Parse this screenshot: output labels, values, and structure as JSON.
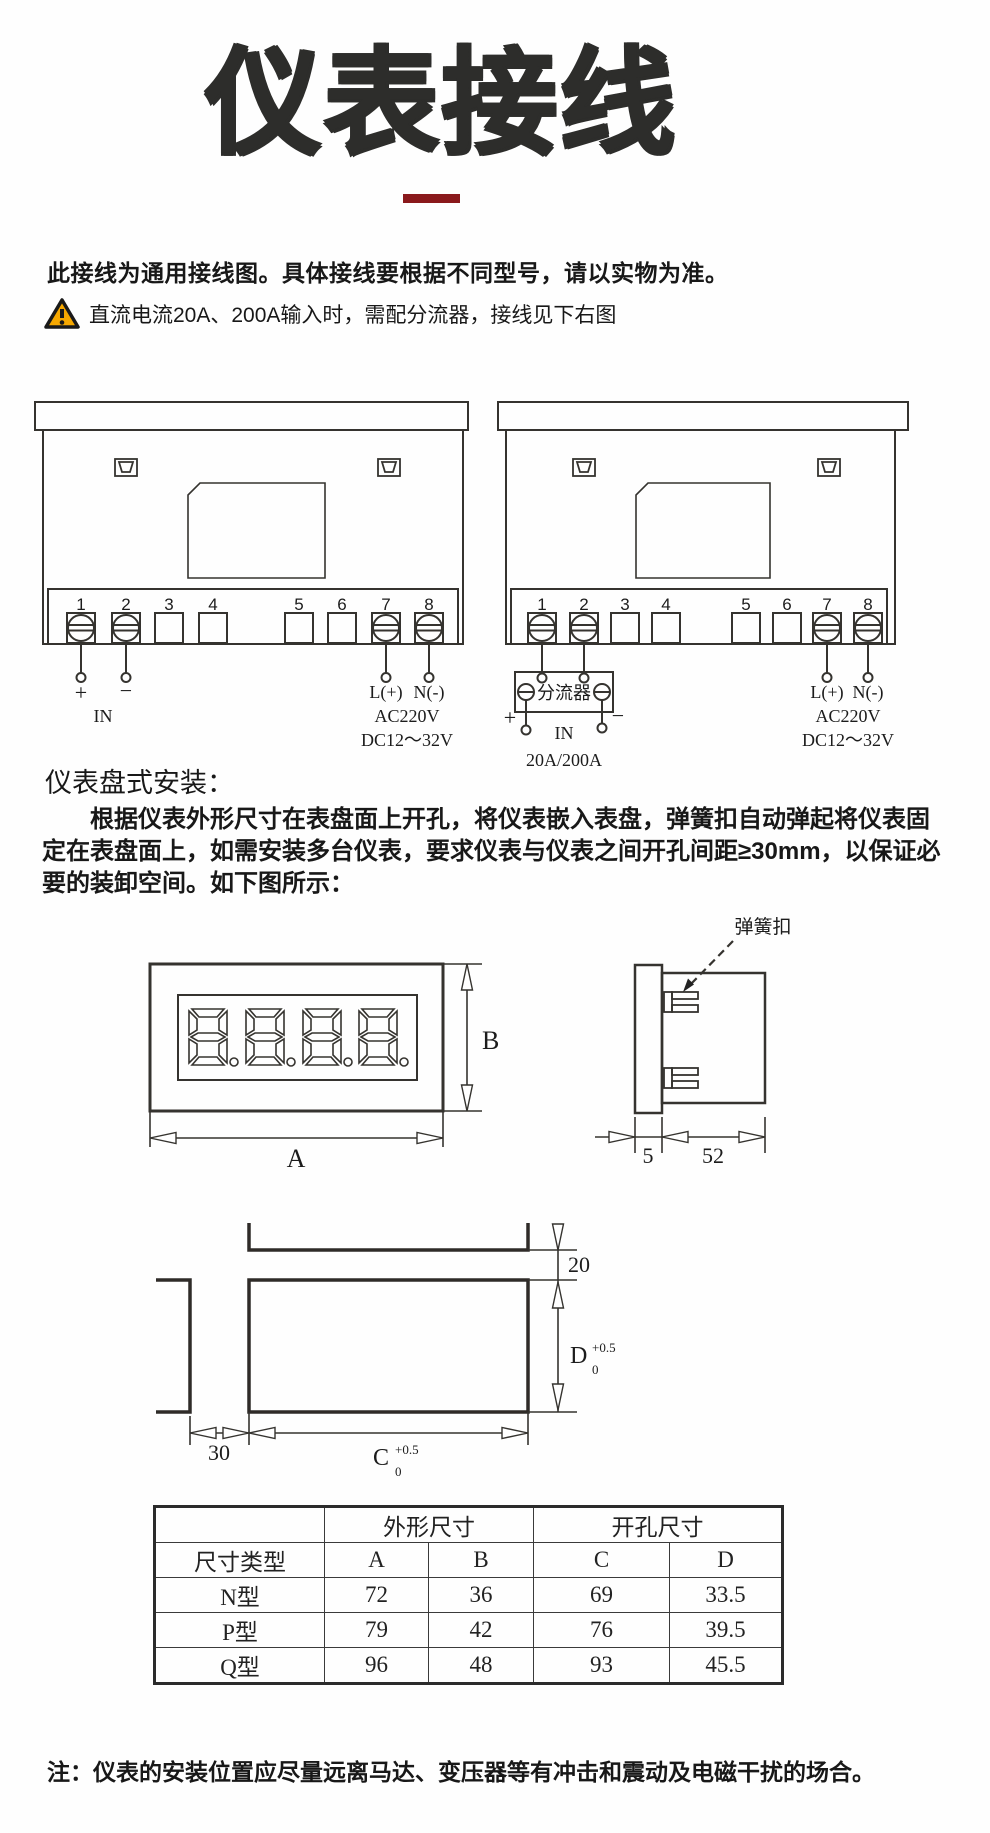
{
  "page": {
    "title": "仪表接线",
    "notice": "此接线为通用接线图。具体接线要根据不同型号，请以实物为准。",
    "warning": "直流电流20A、200A输入时，需配分流器，接线见下右图",
    "accent_red": "#8a191c",
    "warning_yellow": "#f6a800",
    "line_color": "#35332f"
  },
  "wiring": {
    "terminals": [
      "1",
      "2",
      "3",
      "4",
      "5",
      "6",
      "7",
      "8"
    ],
    "left": {
      "plus": "+",
      "minus": "−",
      "in_label": "IN",
      "l_label": "L(+)",
      "n_label": "N(-)",
      "ac": "AC220V",
      "dc": "DC12～32V"
    },
    "right": {
      "shunt": "分流器",
      "plus": "+",
      "minus": "−",
      "in_label": "IN",
      "rating": "20A/200A",
      "l_label": "L(+)",
      "n_label": "N(-)",
      "ac": "AC220V",
      "dc": "DC12～32V"
    }
  },
  "install": {
    "heading": "仪表盘式安装：",
    "paragraph": "根据仪表外形尺寸在表盘面上开孔，将仪表嵌入表盘，弹簧扣自动弹起将仪表固定在表盘面上，如需安装多台仪表，要求仪表与仪表之间开孔间距≥30mm，以保证必要的装卸空间。如下图所示：",
    "spring_clip": "弹簧扣",
    "dims": {
      "a": "A",
      "b": "B",
      "bezel": "5",
      "body": "52",
      "gap_v": "20",
      "gap_h": "30",
      "c": "C",
      "d": "D",
      "tol_sup": "+0.5",
      "tol_sub": "0"
    }
  },
  "table": {
    "group": {
      "outline": "外形尺寸",
      "cutout": "开孔尺寸"
    },
    "cols": {
      "type": "尺寸类型",
      "a": "A",
      "b": "B",
      "c": "C",
      "d": "D"
    },
    "rows": [
      {
        "type": "N型",
        "a": "72",
        "b": "36",
        "c": "69",
        "d": "33.5"
      },
      {
        "type": "P型",
        "a": "79",
        "b": "42",
        "c": "76",
        "d": "39.5"
      },
      {
        "type": "Q型",
        "a": "96",
        "b": "48",
        "c": "93",
        "d": "45.5"
      }
    ]
  },
  "note": {
    "text": "注：仪表的安装位置应尽量远离马达、变压器等有冲击和震动及电磁干扰的场合。"
  }
}
